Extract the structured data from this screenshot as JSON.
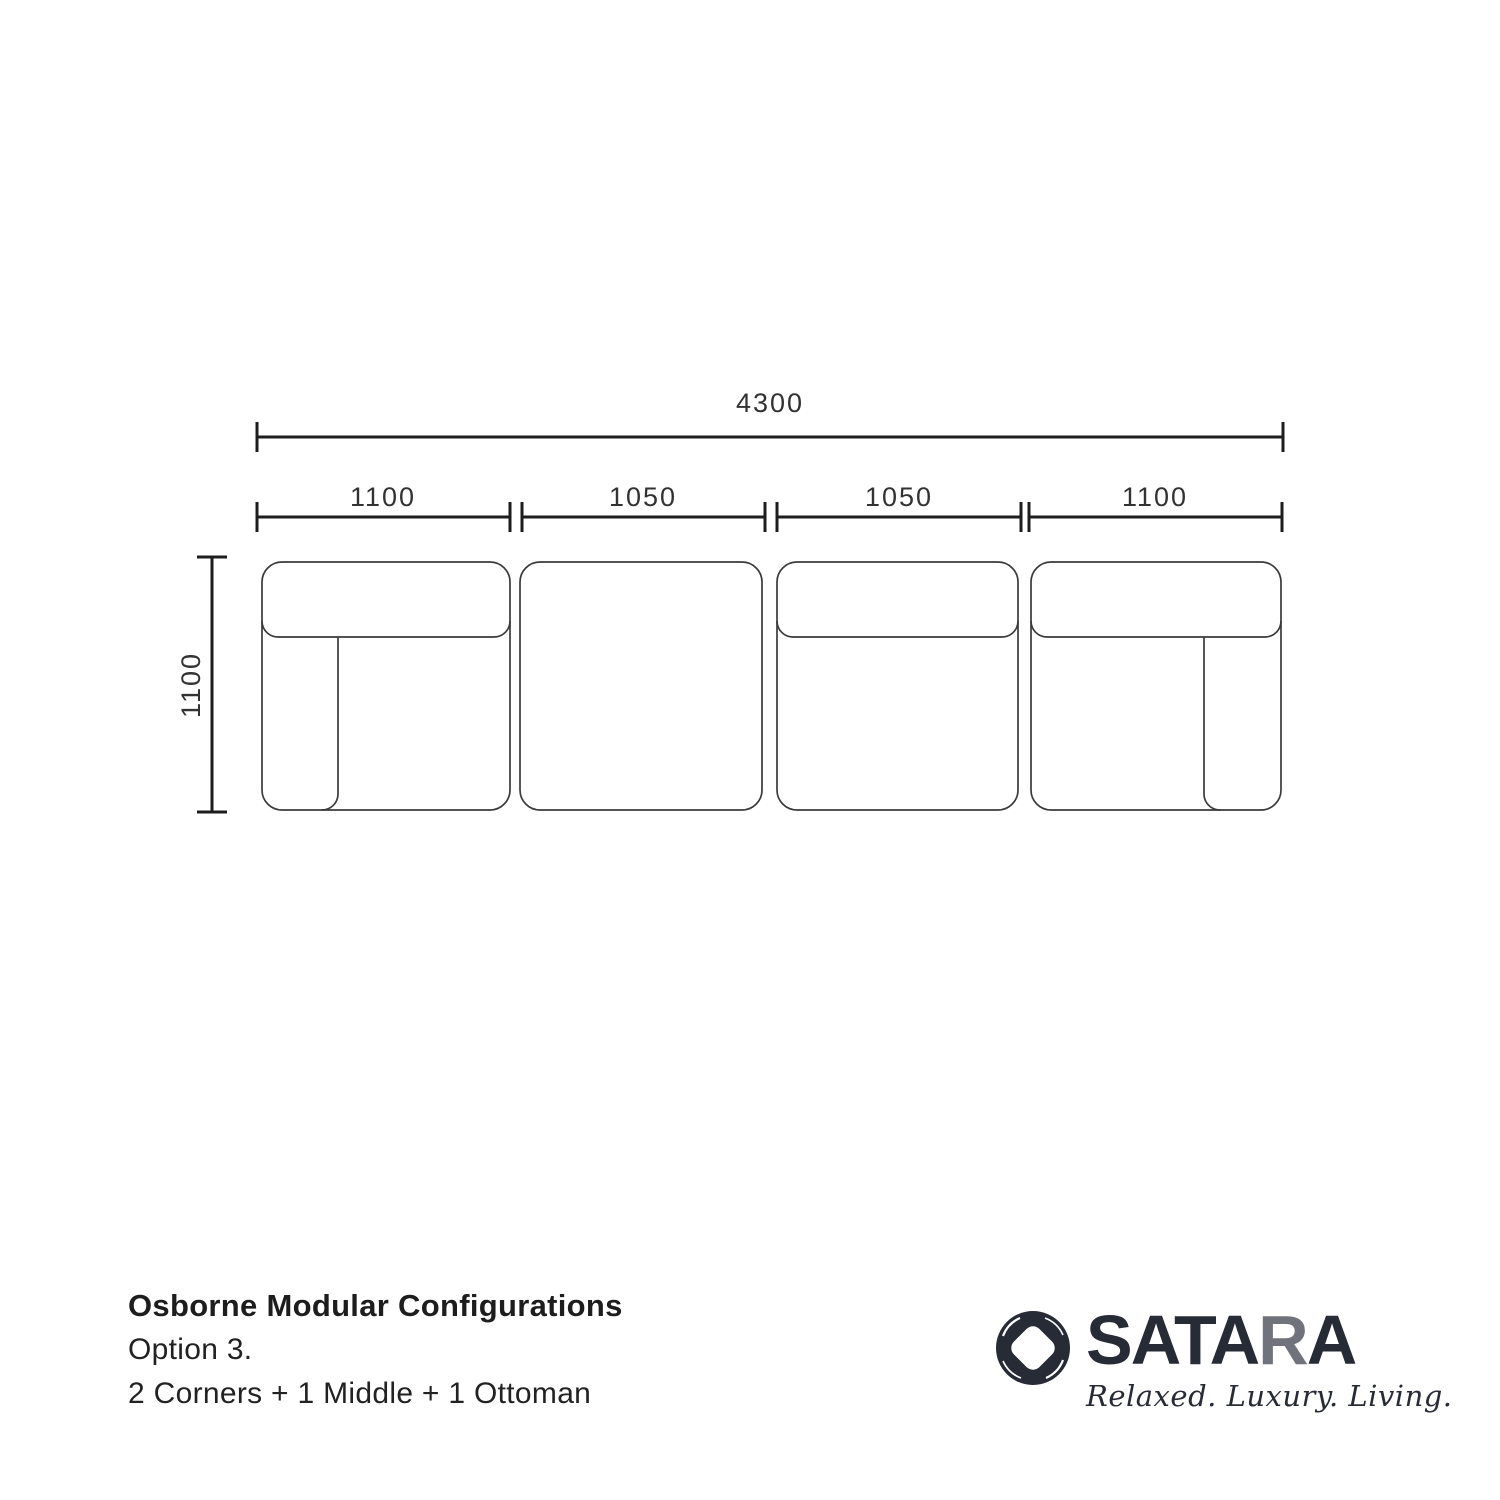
{
  "diagram": {
    "title_hidden": "",
    "total_dimension": {
      "label": "4300"
    },
    "segments": [
      {
        "label": "1100",
        "module": "corner-left"
      },
      {
        "label": "1050",
        "module": "ottoman"
      },
      {
        "label": "1050",
        "module": "middle"
      },
      {
        "label": "1100",
        "module": "corner-right"
      }
    ],
    "depth_dimension": {
      "label": "1100"
    },
    "dimensions_mm": {
      "total": 4300,
      "segments": [
        1100,
        1050,
        1050,
        1100
      ],
      "depth": 1100
    }
  },
  "caption": {
    "title": "Osborne Modular Configurations",
    "option": "Option 3.",
    "configuration": "2 Corners + 1 Middle + 1 Ottoman"
  },
  "brand": {
    "name_prefix": "SATA",
    "name_gray": "R",
    "name_suffix": "A",
    "tagline": "Relaxed. Luxury. Living.",
    "color_dark": "#272b36",
    "color_gray": "#70737c"
  },
  "colors": {
    "background": "#ffffff",
    "dimension_line": "#1d1d1d",
    "module_line": "#3b3b3b",
    "label_text": "#323232"
  }
}
